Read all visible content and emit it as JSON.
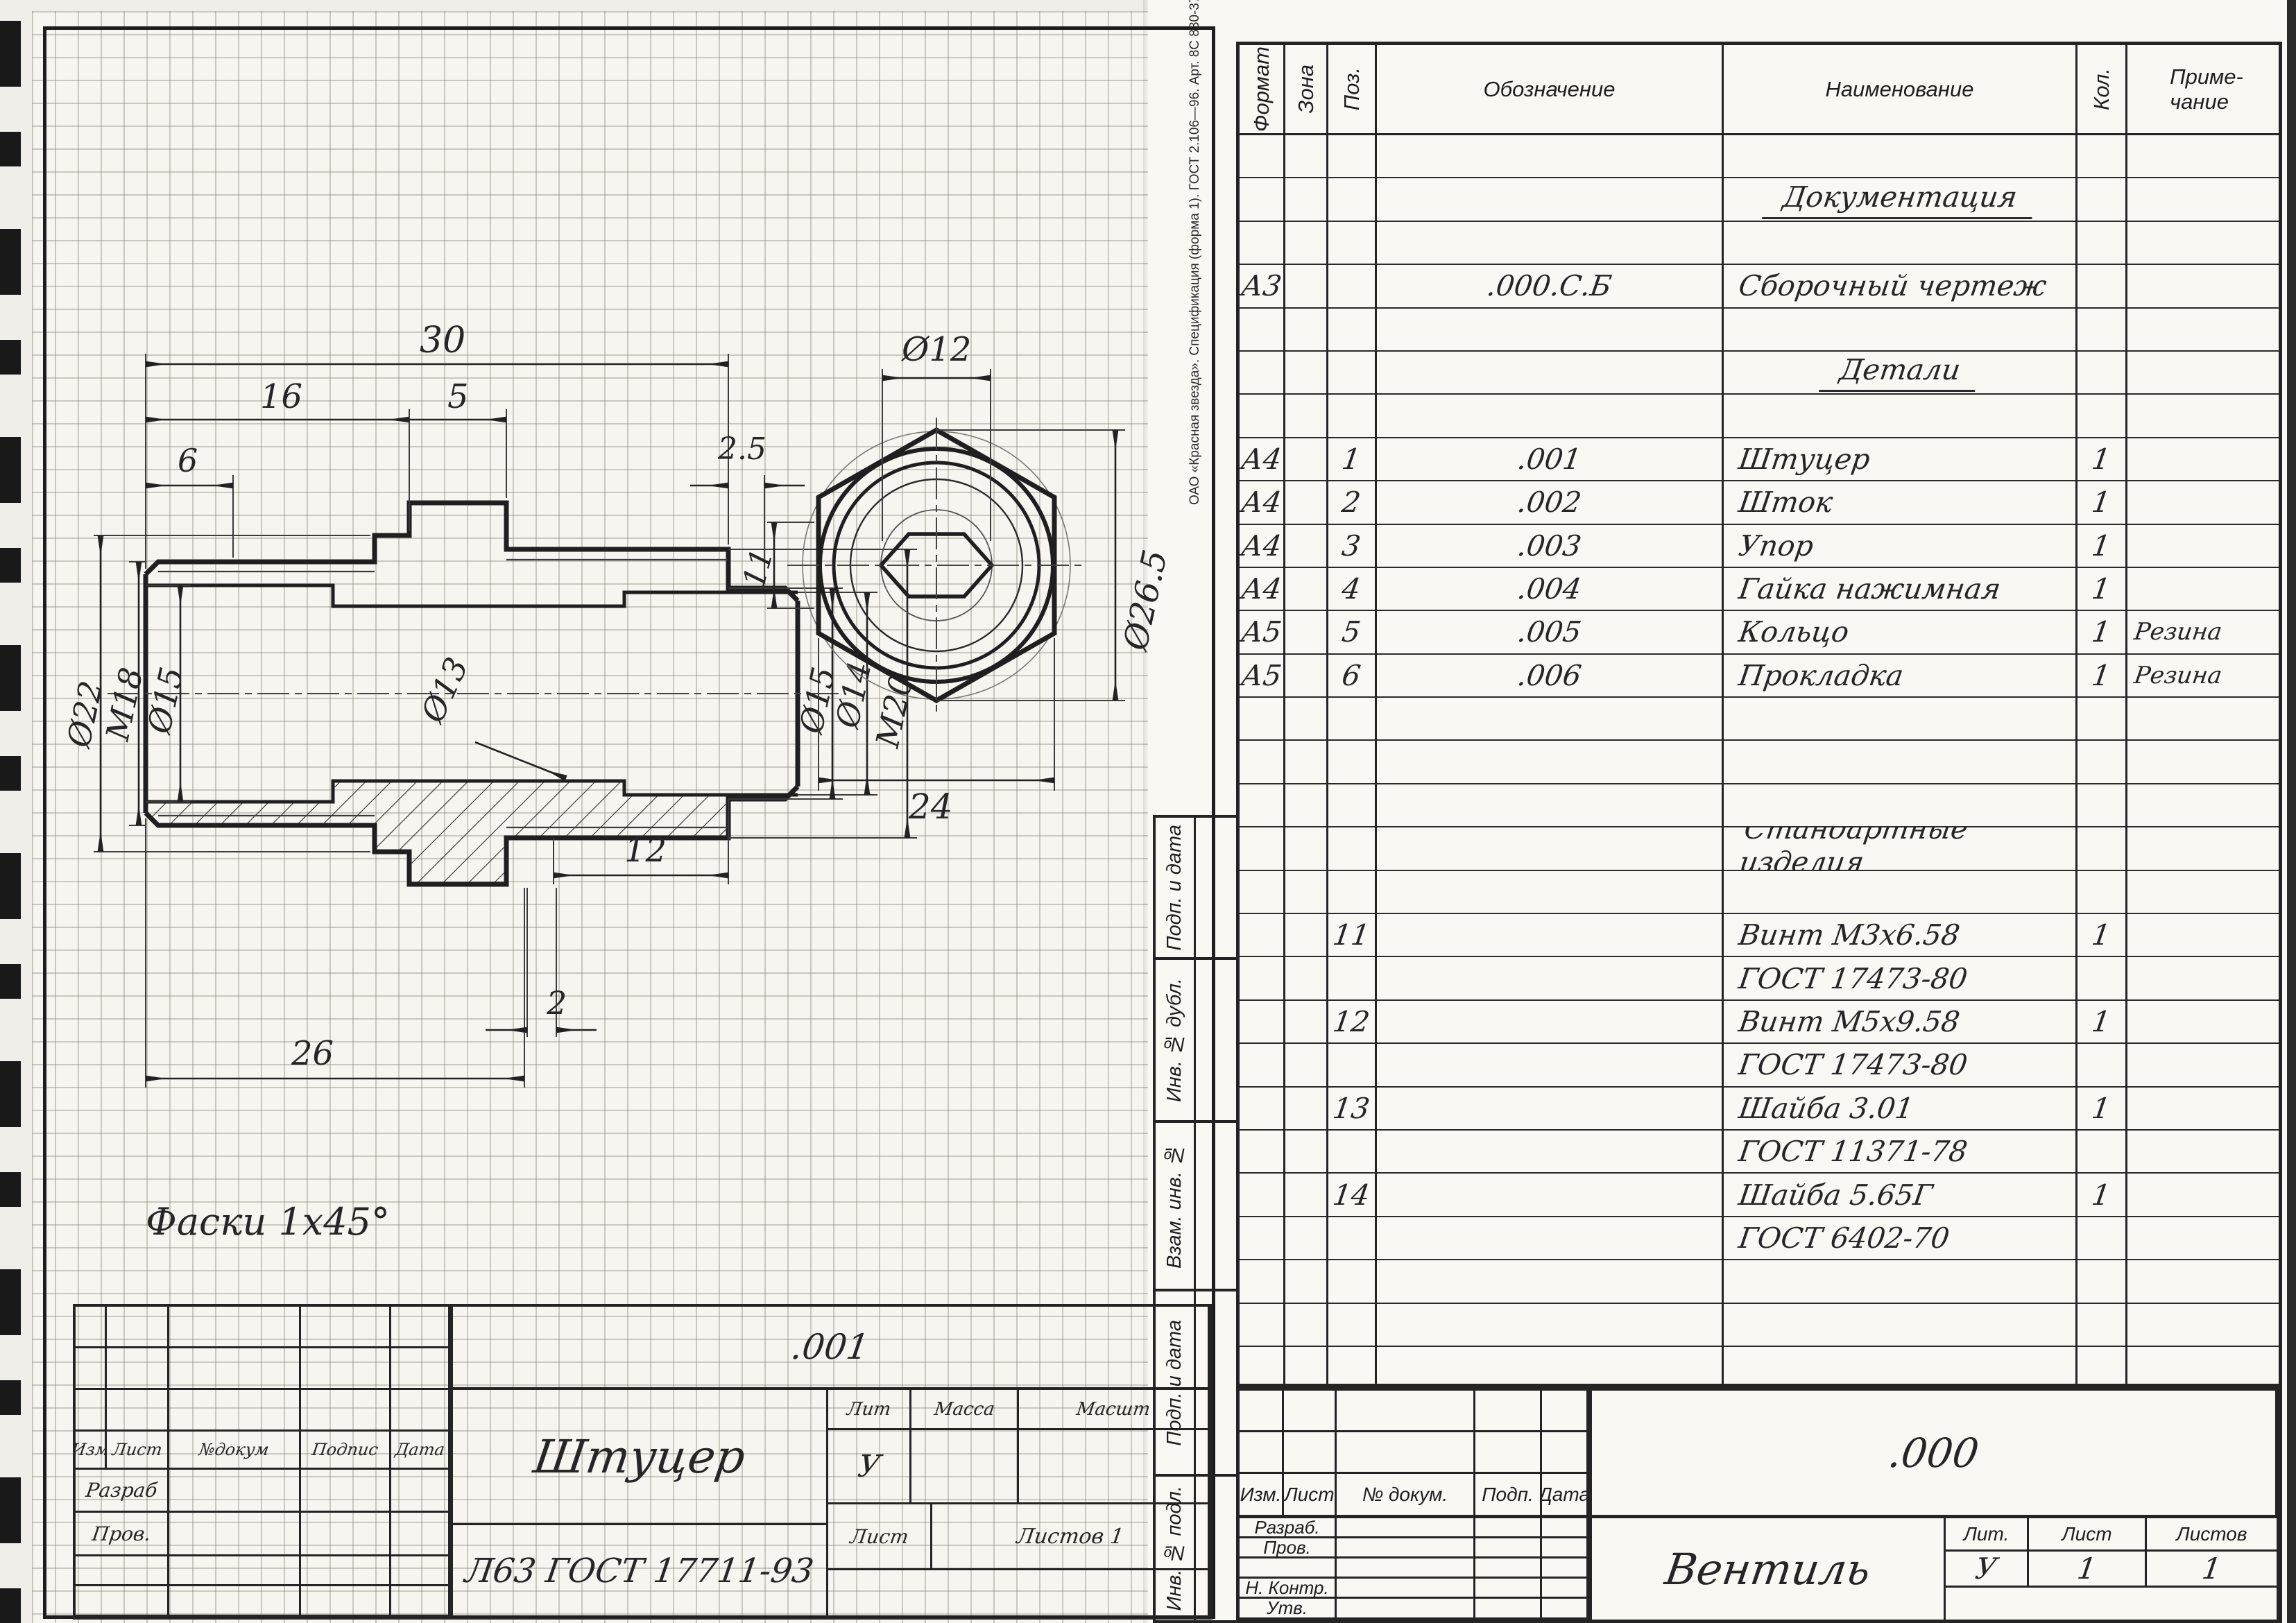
{
  "stamp_text": "ОАО «Красная звезда». Спецификация (форма 1). ГОСТ 2.106—96. Арт. 8С 830-37540435",
  "drawing_sheet": {
    "note": "Фаски 1х45°",
    "dims": {
      "len30": "30",
      "len16": "16",
      "len5": "5",
      "len6": "6",
      "len25": "2.5",
      "d22": "Ø22",
      "m18": "М18",
      "d15l": "Ø15",
      "d13": "Ø13",
      "len12": "12",
      "d15r": "Ø15",
      "d14": "Ø14",
      "m20": "М20",
      "len2": "2",
      "len26": "26",
      "d12": "Ø12",
      "d265": "Ø26.5",
      "len24": "24",
      "len11": "11"
    },
    "title_block": {
      "designation": ".001",
      "name": "Штуцер",
      "material": "Л63 ГОСТ 17711-93",
      "sig_cols": [
        "Изм",
        "Лист",
        "№докум",
        "Подпис",
        "Дата"
      ],
      "sig_rows": [
        "Разраб",
        "Пров."
      ],
      "props": [
        "Лит",
        "Масса",
        "Масшт"
      ],
      "lit_value": "У",
      "sheet_label": "Лист",
      "sheets_label": "Листов 1"
    }
  },
  "spec_sheet": {
    "margin_labels": [
      "Подп. и дата",
      "Инв. № дубл.",
      "Взам. инв. №",
      "Подп. и дата",
      "Инв. № подл."
    ],
    "header": {
      "format": "Формат",
      "zone": "Зона",
      "pos": "Поз.",
      "designation": "Обозначение",
      "name": "Наименование",
      "qty": "Кол.",
      "note": "Приме-\nчание"
    },
    "rows": [
      {},
      {
        "name": "Документация",
        "section": true
      },
      {},
      {
        "format": "А3",
        "designation": ".000.С.Б",
        "name": "Сборочный чертеж"
      },
      {},
      {
        "name": "Детали",
        "section": true
      },
      {},
      {
        "format": "А4",
        "pos": "1",
        "designation": ".001",
        "name": "Штуцер",
        "qty": "1"
      },
      {
        "format": "А4",
        "pos": "2",
        "designation": ".002",
        "name": "Шток",
        "qty": "1"
      },
      {
        "format": "А4",
        "pos": "3",
        "designation": ".003",
        "name": "Упор",
        "qty": "1"
      },
      {
        "format": "А4",
        "pos": "4",
        "designation": ".004",
        "name": "Гайка нажимная",
        "qty": "1"
      },
      {
        "format": "А5",
        "pos": "5",
        "designation": ".005",
        "name": "Кольцо",
        "qty": "1",
        "note": "Резина"
      },
      {
        "format": "А5",
        "pos": "6",
        "designation": ".006",
        "name": "Прокладка",
        "qty": "1",
        "note": "Резина"
      },
      {},
      {},
      {},
      {
        "name": "Стандартные изделия",
        "section": true
      },
      {},
      {
        "pos": "11",
        "name": "Винт М3х6.58",
        "qty": "1"
      },
      {
        "name": "ГОСТ 17473-80"
      },
      {
        "pos": "12",
        "name": "Винт М5х9.58",
        "qty": "1"
      },
      {
        "name": "ГОСТ 17473-80"
      },
      {
        "pos": "13",
        "name": "Шайба 3.01",
        "qty": "1"
      },
      {
        "name": "ГОСТ 11371-78"
      },
      {
        "pos": "14",
        "name": "Шайба 5.65Г",
        "qty": "1"
      },
      {
        "name": "ГОСТ 6402-70"
      },
      {},
      {},
      {}
    ],
    "title_block": {
      "designation": ".000",
      "product": "Вентиль",
      "sig_cols": [
        "Изм.",
        "Лист",
        "№ докум.",
        "Подп.",
        "Дата"
      ],
      "sig_rows": [
        "Разраб.",
        "Пров.",
        "",
        "Н. Контр.",
        "Утв."
      ],
      "lit_cols": [
        "Лит.",
        "Лист",
        "Листов"
      ],
      "lit_values": [
        "У",
        "1",
        "1"
      ]
    }
  }
}
